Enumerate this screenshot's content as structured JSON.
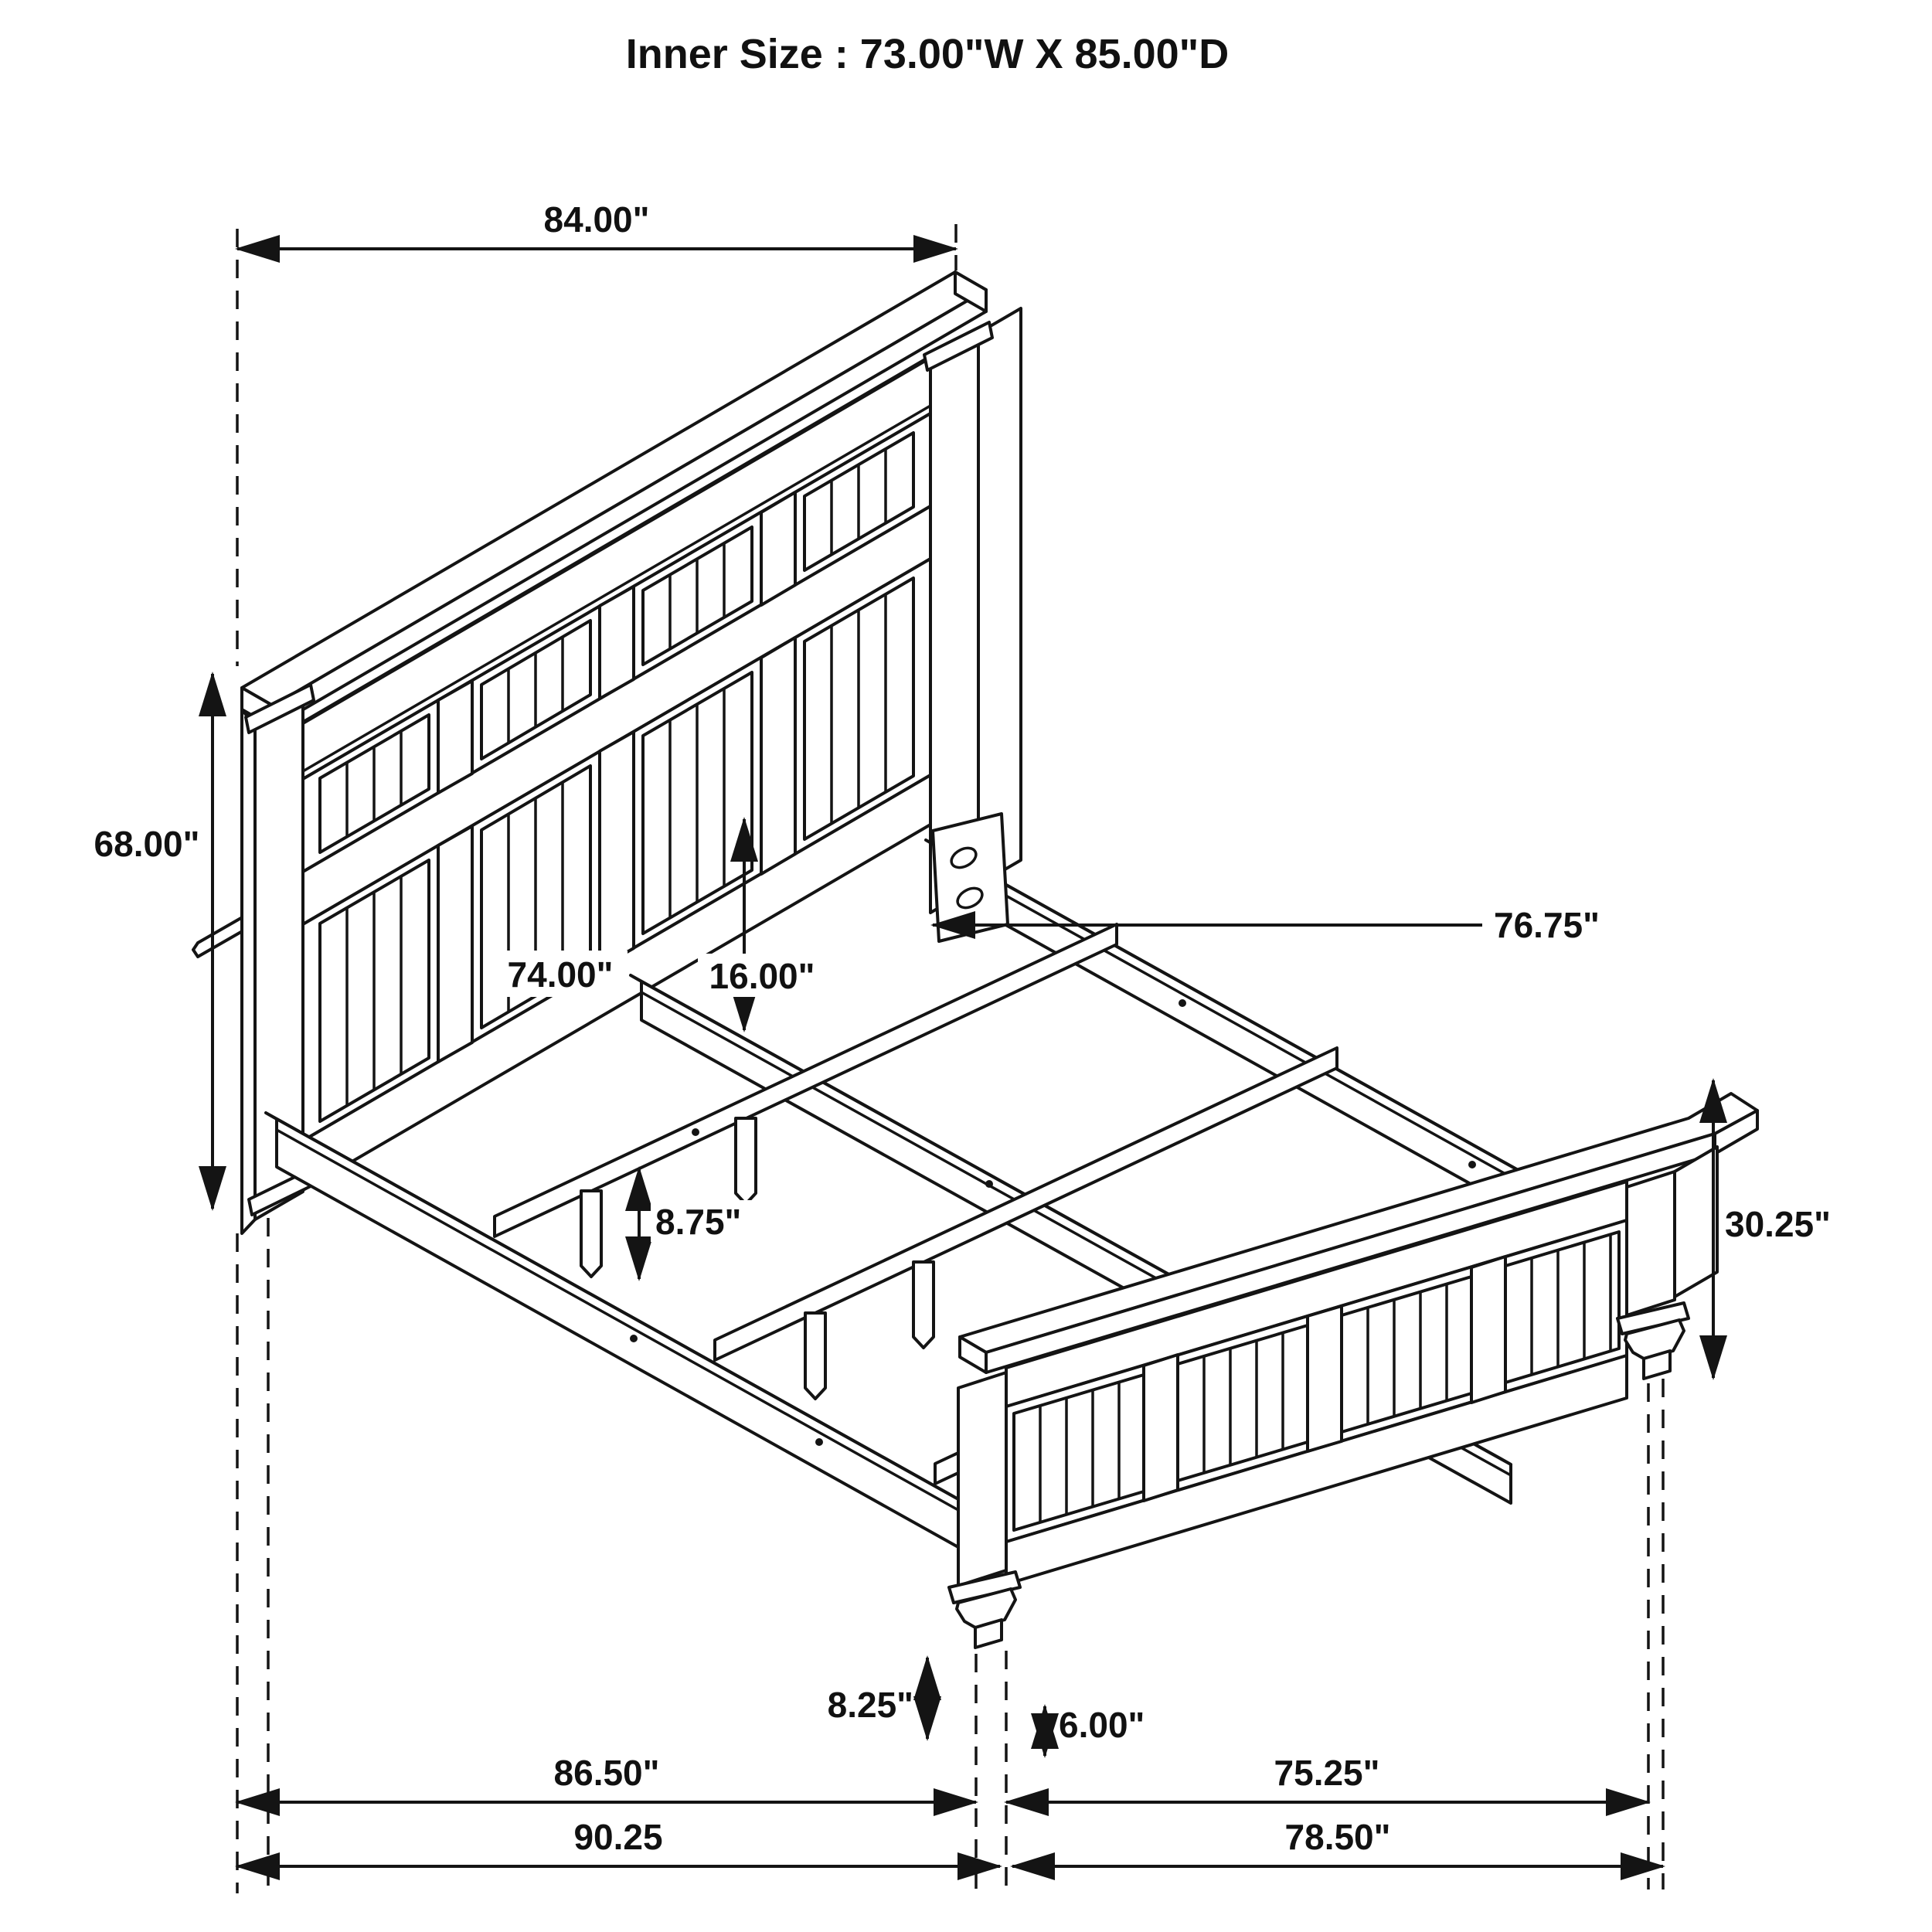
{
  "title": "Inner Size : 73.00\"W X 85.00\"D",
  "drawing": {
    "type": "isometric-line-drawing",
    "subject": "panel bed frame with headboard, footboard, side rails and slats",
    "line_color": "#141414",
    "background_color": "#ffffff"
  },
  "dimensions": {
    "headboard_width": "84.00\"",
    "headboard_height": "68.00\"",
    "headboard_inner_width": "74.00\"",
    "rail_clearance_height": "16.00\"",
    "side_rail_length": "76.75\"",
    "slat_leg_height": "8.75\"",
    "footboard_height": "30.25\"",
    "footboard_foot_height": "8.25\"",
    "footboard_leg_height": "6.00\"",
    "frame_inner_length": "86.50\"",
    "footboard_inner_width": "75.25\"",
    "frame_overall_length": "90.25",
    "footboard_overall_width": "78.50\""
  }
}
